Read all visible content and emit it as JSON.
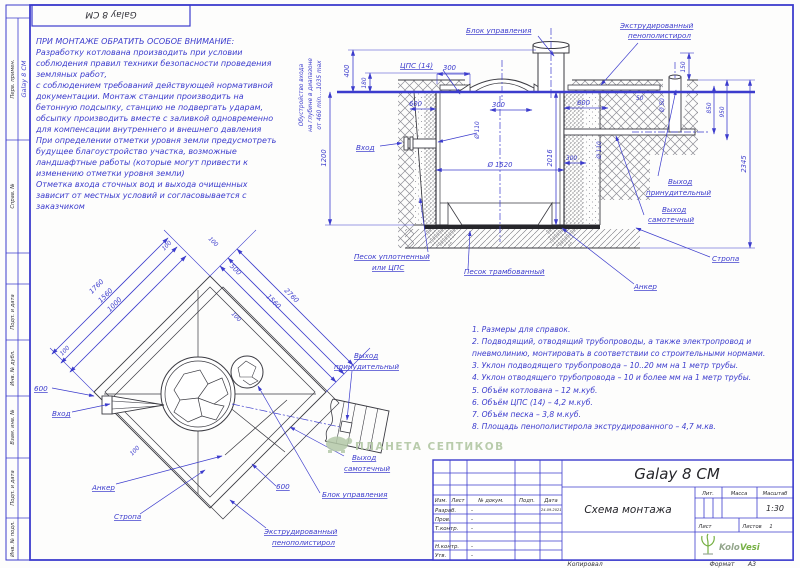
{
  "sheet": {
    "top_stamp": "Galay 8 CM",
    "watermark_text": "ПЛАНЕТА СЕПТИКОВ",
    "footer_copied": "Копировал",
    "footer_format_label": "Формат",
    "footer_format_value": "А3",
    "colors": {
      "blueprint": "#3c3ccd",
      "line_dark": "#3b3b42",
      "watermark_green": "#aec49f",
      "logo_green": "#76b043"
    }
  },
  "left_strip": {
    "cells": [
      {
        "label": "Перв. примен.",
        "value": "Galay 8 CM"
      },
      {
        "label": "Справ. №"
      },
      {
        "label": "Подп. и дата"
      },
      {
        "label": "Инв. № дубл."
      },
      {
        "label": "Взам. инв. №"
      },
      {
        "label": "Подп. и дата"
      },
      {
        "label": "Инв. № подл."
      }
    ]
  },
  "notes_block": {
    "title": "ПРИ МОНТАЖЕ ОБРАТИТЬ ОСОБОЕ ВНИМАНИЕ:",
    "lines": [
      "Разработку котлована производить при условии",
      "соблюдения правил техники безопасности проведения",
      "земляных работ,",
      "с соблюдением требований действующей нормативной",
      "документации. Монтаж станции производить на",
      "бетонную подсыпку, станцию не подвергать ударам,",
      "обсыпку производить вместе с заливкой одновременно",
      "для компенсации внутреннего и внешнего давления",
      "При определении отметки уровня земли предусмотреть",
      "будущее благоустройство участка, возможные",
      "ландшафтные работы (которые могут привести к",
      "изменению отметки уровня земли)",
      "Отметка входа сточных вод и выхода очищенных",
      "зависит от местных условий и согласовывается с",
      "заказчиком"
    ]
  },
  "section_view": {
    "inlet_depth_note": [
      "Обустройство входа",
      "на глубине в диапазоне",
      "от 460 min....1035 max"
    ],
    "dims": {
      "d400": "400",
      "d180": "180",
      "d1200": "1200",
      "cps": "ЦПС (14)",
      "d300_top": "300",
      "d600_left": "600",
      "d300_inner": "300",
      "d600_right": "600",
      "d110_left": "Ø 110",
      "d2016": "2016",
      "d1520": "Ø 1520",
      "d110_right": "Ø 110",
      "d300_right": "300",
      "d150": "150",
      "d50_pipe": "Ø 50",
      "d50": "50",
      "d850": "850",
      "d950": "950",
      "d2345": "2345"
    },
    "labels": {
      "control_unit": "Блок управления",
      "eps1": "Экструдированный",
      "eps2": "пенополистирол",
      "inlet": "Вход",
      "outlet_forced1": "Выход",
      "outlet_forced2": "принудительный",
      "outlet_gravity1": "Выход",
      "outlet_gravity2": "самотечный",
      "sand_compacted1": "Песок уплотненный",
      "sand_compacted2": "или  ЦПС",
      "sand_tamped": "Песок трамбованный",
      "anchor": "Анкер",
      "sling": "Стропа"
    }
  },
  "plan_view": {
    "dims": {
      "d1760": "1760",
      "d1560_left": "1560",
      "d1000": "1000",
      "d100_a": "100",
      "d100_b": "100",
      "d100_c": "100",
      "d100_d": "100",
      "d100_e": "100",
      "d500": "500",
      "d1560_right": "1560",
      "d2760": "2760",
      "d600_left": "600",
      "d600_bottom": "600"
    },
    "labels": {
      "inlet": "Вход",
      "outlet_forced1": "Выход",
      "outlet_forced2": "принудительный",
      "outlet_gravity1": "Выход",
      "outlet_gravity2": "самотечный",
      "anchor": "Анкер",
      "sling": "Стропа",
      "eps1": "Экструдированный",
      "eps2": "пенополистирол",
      "control_unit": "Блок управления"
    }
  },
  "notes_list": {
    "lines": [
      "1. Размеры для справок.",
      "2. Подводящий, отводящий трубопроводы, а также электропровод и",
      "пневмолинию, монтировать в соответствии со строительными нормами.",
      "3. Уклон подводящего трубопровода – 10..20 мм на 1 метр трубы.",
      "4. Уклон отводящего трубопровода – 10 и более мм на 1 метр трубы.",
      "5. Объём котлована – 12 м.куб.",
      "6. Объём ЦПС (14) – 4,2 м.куб.",
      "7. Объём песка – 3,8 м.куб.",
      "8. Площадь пенополистирола экструдированного – 4,7 м.кв."
    ]
  },
  "title_block": {
    "product": "Galay 8 CM",
    "doc_name": "Схема монтажа",
    "header": {
      "izm": "Изм.",
      "list": "Лист",
      "doc": "№ докум.",
      "sign": "Подп.",
      "date": "Дата"
    },
    "rows": [
      {
        "role": "Разраб.",
        "doc": "-",
        "date": "24.09.2021"
      },
      {
        "role": "Пров.",
        "doc": "-"
      },
      {
        "role": "Т.контр.",
        "doc": "-"
      },
      {
        "role": "Н.контр.",
        "doc": "-"
      },
      {
        "role": "Утв.",
        "doc": "-"
      }
    ],
    "lit_label": "Лит.",
    "mass_label": "Масса",
    "scale_label": "Масштаб",
    "scale_value": "1:30",
    "sheet_label": "Лист",
    "sheets_label": "Листов",
    "sheets_value": "1",
    "logo_kolo": "Kolo",
    "logo_vesi": "Vesi"
  }
}
